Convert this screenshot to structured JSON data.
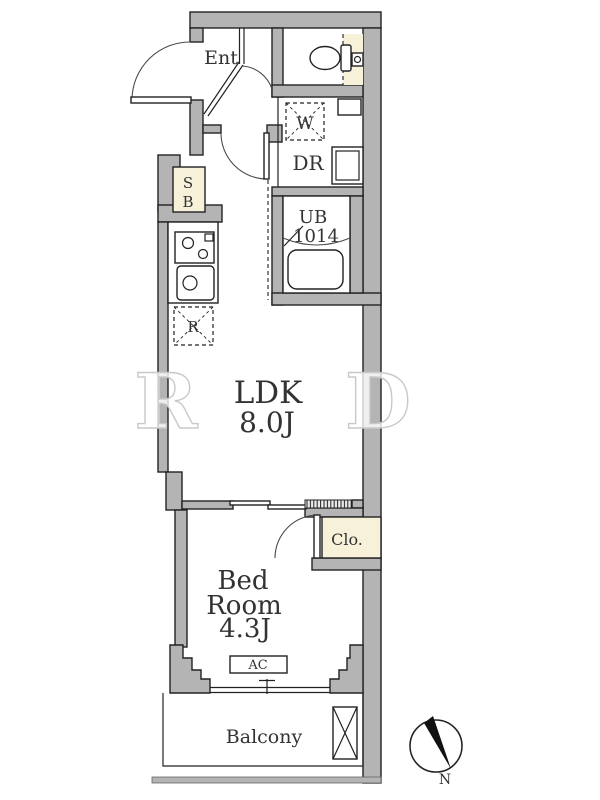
{
  "floorplan": {
    "labels": {
      "entrance": "Ent",
      "dressing_room": "DR",
      "washer": "W",
      "unit_bath_line1": "UB",
      "unit_bath_line2": "1014",
      "shoe_box_line1": "S",
      "shoe_box_line2": "B",
      "fridge": "R",
      "ldk_name": "LDK",
      "ldk_size": "8.0J",
      "closet": "Clo.",
      "bedroom_line1": "Bed",
      "bedroom_line2": "Room",
      "bedroom_size": "4.3J",
      "ac": "AC",
      "balcony": "Balcony",
      "compass_north": "N"
    },
    "watermark": {
      "letter_left": "R",
      "letter_right": "D"
    },
    "colors": {
      "wall_fill": "#b4b4b4",
      "accent_cream": "#f6f1d8",
      "line": "#222222",
      "text": "#333333"
    }
  }
}
